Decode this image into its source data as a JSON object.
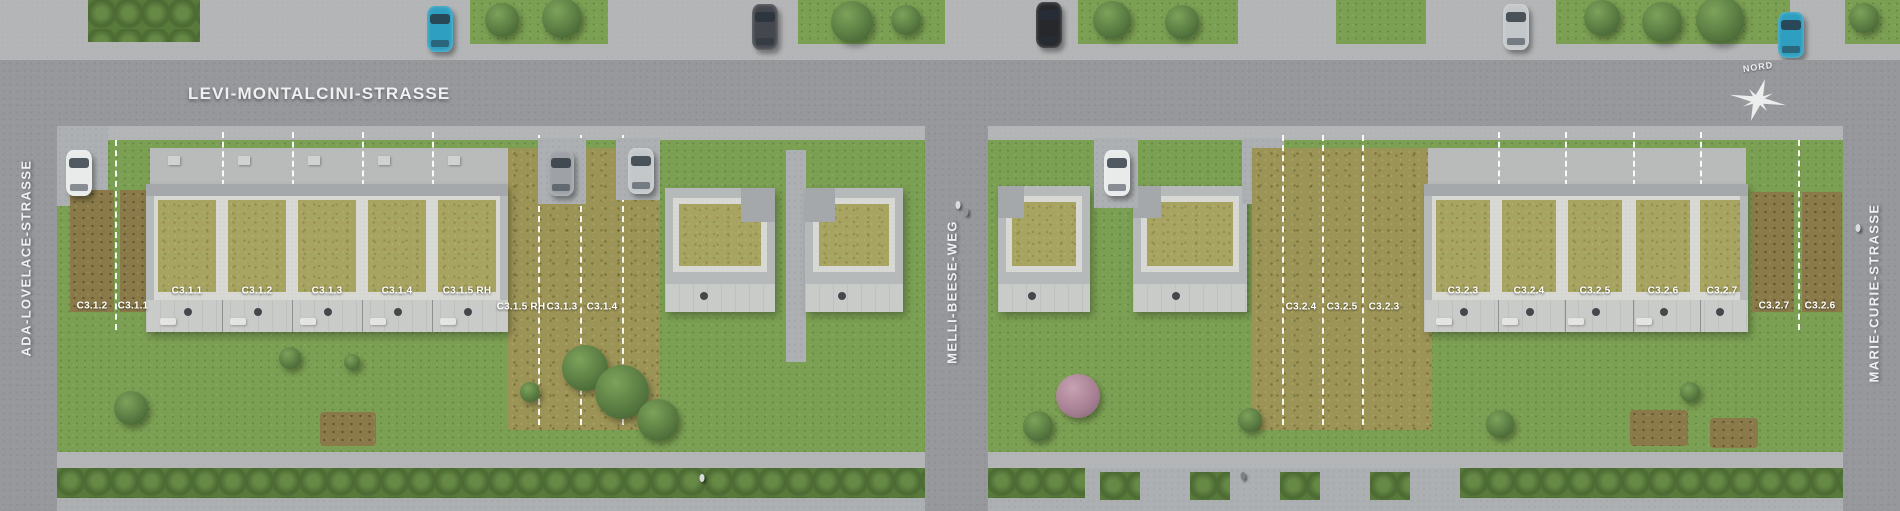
{
  "streets": {
    "top": "LEVI-MONTALCINI-STRASSE",
    "left": "ADA-LOVELACE-STRASSE",
    "middle": "MELLI-BEESE-WEG",
    "right": "MARIE-CURIE-STRASSE"
  },
  "compass": {
    "north": "NORD"
  },
  "units": {
    "left": {
      "roof": [
        "C3.1.1",
        "C3.1.2",
        "C3.1.3",
        "C3.1.4",
        "C3.1.5 RH"
      ],
      "west": [
        "C3.1.2",
        "C3.1.1"
      ],
      "east": [
        "C3.1.5 RH",
        "C3.1.3",
        "C3.1.4"
      ]
    },
    "right": {
      "west": [
        "C3.2.4",
        "C3.2.5",
        "C3.2.3"
      ],
      "roof": [
        "C3.2.3",
        "C3.2.4",
        "C3.2.5",
        "C3.2.6",
        "C3.2.7"
      ],
      "east": [
        "C3.2.7",
        "C3.2.6"
      ]
    }
  },
  "colors": {
    "asphalt": "#96989c",
    "sidewalk": "#b3b5b6",
    "lawn": "#7b9f53",
    "meadow": "#9c9456",
    "sedum_roof": "#a7a462",
    "gravel": "#d8d8d4",
    "building": "#b6b9ba",
    "terrace": "#c9cbc9",
    "hedge": "#587a3b",
    "garden_bed": "#8a7a4a",
    "property_line": "#ffffff",
    "label_text": "#ffffff",
    "car_teal": "#2e9fc0",
    "car_white": "#e9ebeb",
    "car_silver": "#c3c7ca",
    "car_dark": "#44484e",
    "car_black": "#26282c"
  }
}
